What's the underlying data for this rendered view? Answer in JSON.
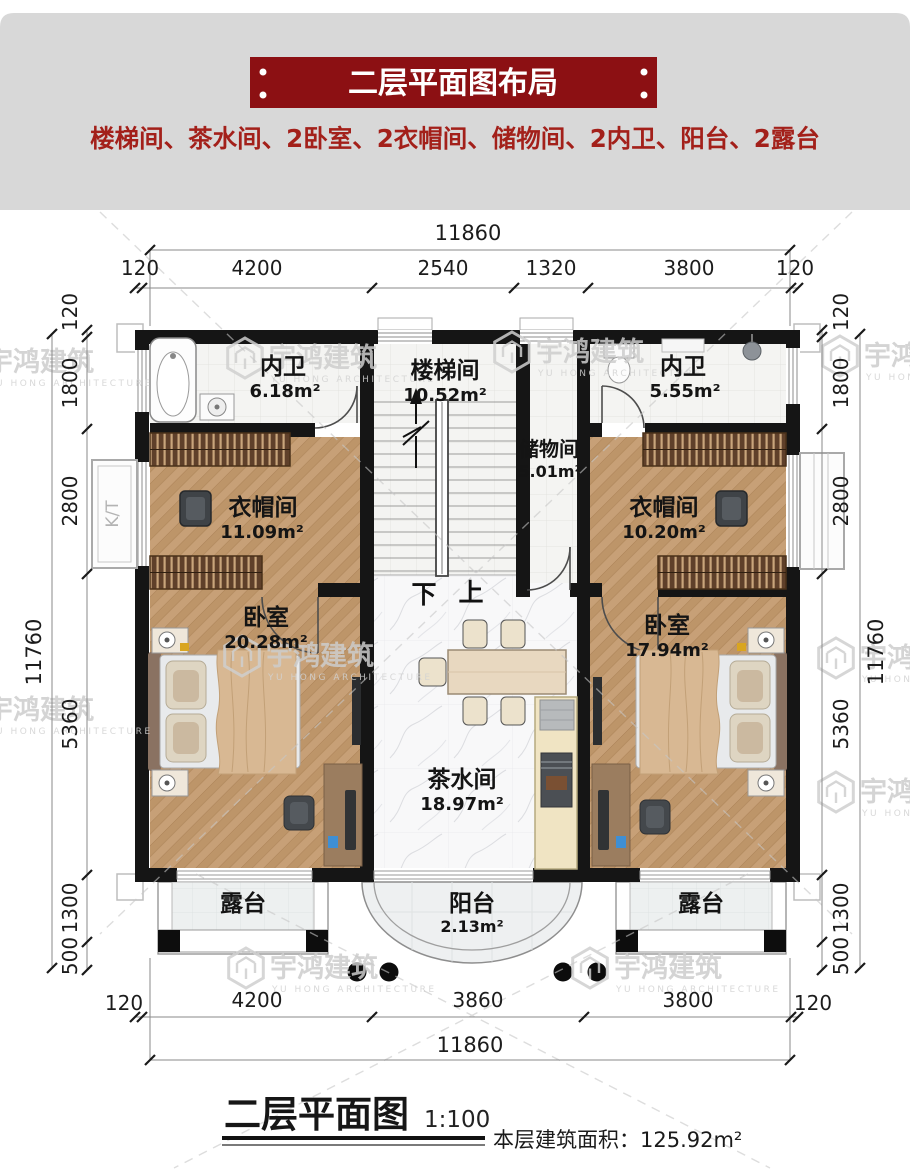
{
  "header": {
    "banner_title": "二层平面图布局",
    "subtitle": "楼梯间、茶水间、2卧室、2衣帽间、储物间、2内卫、阳台、2露台"
  },
  "colors": {
    "banner_red": "#8c1013",
    "subtitle_red": "#a3201a",
    "band_gray": "#d8d8d8",
    "wall_black": "#151515",
    "wood": "#c7a077"
  },
  "watermark": {
    "cn": "宇鸿建筑",
    "en": "YU HONG ARCHITECTURE"
  },
  "rooms": {
    "bath_left": {
      "name": "内卫",
      "area": "6.18m²"
    },
    "stair": {
      "name": "楼梯间",
      "area": "10.52m²"
    },
    "storage": {
      "name": "储物间",
      "area": "5.01m²"
    },
    "bath_right": {
      "name": "内卫",
      "area": "5.55m²"
    },
    "cloak_left": {
      "name": "衣帽间",
      "area": "11.09m²"
    },
    "cloak_right": {
      "name": "衣帽间",
      "area": "10.20m²"
    },
    "bed_left": {
      "name": "卧室",
      "area": "20.28m²"
    },
    "bed_right": {
      "name": "卧室",
      "area": "17.94m²"
    },
    "tea": {
      "name": "茶水间",
      "area": "18.97m²"
    },
    "balcony": {
      "name": "阳台",
      "area": "2.13m²"
    },
    "terrace_left": {
      "name": "露台"
    },
    "terrace_right": {
      "name": "露台"
    }
  },
  "stair_marks": {
    "down": "下",
    "up": "上"
  },
  "side_mark": "K/T",
  "dims": {
    "top": {
      "total": "11860",
      "segs": [
        "120",
        "4200",
        "2540",
        "1320",
        "3800",
        "120"
      ]
    },
    "bottom": {
      "total": "11860",
      "segs": [
        "120",
        "4200",
        "3860",
        "3800",
        "120"
      ]
    },
    "left": {
      "total": "11760",
      "segs": [
        "120",
        "1800",
        "2800",
        "5360",
        "1300",
        "500"
      ]
    },
    "right": {
      "total": "11760",
      "segs": [
        "120",
        "1800",
        "2800",
        "5360",
        "1300",
        "500"
      ]
    }
  },
  "footer": {
    "title": "二层平面图",
    "scale": "1:100",
    "area_text": "本层建筑面积：125.92m²"
  }
}
